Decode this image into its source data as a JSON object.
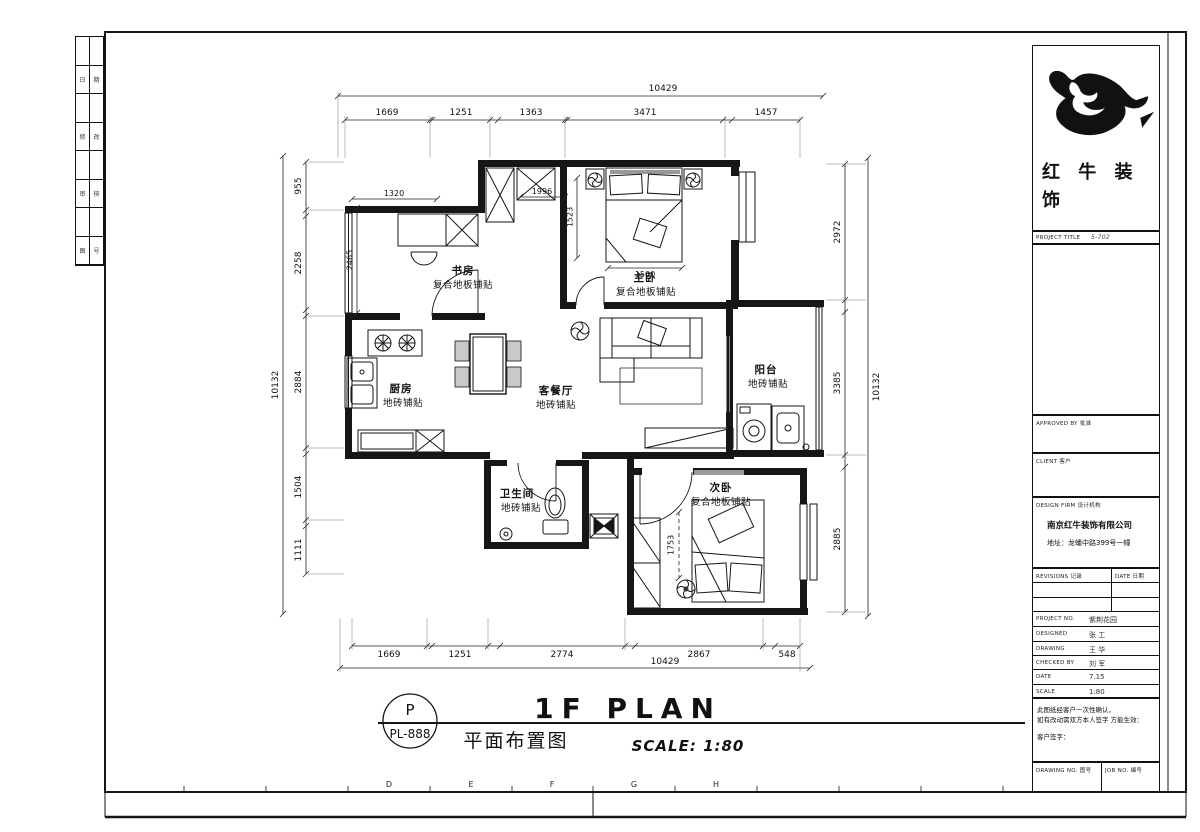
{
  "sheet": {
    "grid_letters": [
      "D",
      "E",
      "F",
      "G",
      "H"
    ],
    "stamp": {
      "symbol": "P",
      "code": "PL-888"
    },
    "title": {
      "en": "1F PLAN",
      "cn": "平面布置图",
      "scale": "SCALE: 1:80"
    }
  },
  "edge_strip": {
    "cells": [
      "日",
      "期",
      "修",
      "改",
      "审",
      "核",
      "图",
      "号"
    ]
  },
  "rooms": {
    "study": {
      "name": "书房",
      "floor": "复合地板铺贴"
    },
    "master": {
      "name": "主卧",
      "floor": "复合地板铺贴"
    },
    "kitchen": {
      "name": "厨房",
      "floor": "地砖铺贴"
    },
    "living": {
      "name": "客餐厅",
      "floor": "地砖铺贴"
    },
    "balcony": {
      "name": "阳台",
      "floor": "地砖铺贴"
    },
    "bath": {
      "name": "卫生间",
      "floor": "地砖铺贴"
    },
    "second": {
      "name": "次卧",
      "floor": "复合地板铺贴"
    }
  },
  "dims": {
    "top_overall": "10429",
    "top": [
      "1669",
      "1251",
      "1363",
      "3471",
      "1457"
    ],
    "bottom": [
      "1669",
      "1251",
      "2774",
      "2867",
      "548"
    ],
    "bottom_overall": "10429",
    "left": [
      "955",
      "2258",
      "2884",
      "1504",
      "1111"
    ],
    "left_overall": "10132",
    "right": [
      "2972",
      "3385",
      "2885"
    ],
    "right_overall": "10132",
    "inner": {
      "study_w": "1320",
      "study_h": "2465",
      "entry": "1996",
      "master_h": "1523",
      "bed_w": "1500",
      "second_h": "1753"
    }
  },
  "panel": {
    "logo_cn_line1": "红 牛 装",
    "logo_cn_line2": "饰",
    "project_title_label": "PROJECT TITLE",
    "project_title_value": "5-702",
    "approved_label": "APPROVED BY  批准",
    "client_label": "CLIENT  客户",
    "firm_label": "DESIGN FIRM  设计机构",
    "company_name": "南京红牛装饰有限公司",
    "company_address": "地址：龙蟠中路399号一幢",
    "revisions_label": "REVISIONS  记录",
    "date_col_label": "DATE  日期",
    "rows": [
      {
        "label": "PROJECT NO.",
        "value": "紫荆花园"
      },
      {
        "label": "DESIGNED",
        "value": "张 工"
      },
      {
        "label": "DRAWING",
        "value": "王 华"
      },
      {
        "label": "CHECKED BY",
        "value": "刘 军"
      },
      {
        "label": "DATE",
        "value": "7.15"
      },
      {
        "label": "SCALE",
        "value": "1:80"
      }
    ],
    "note_line1": "此图纸经客户一次性确认，",
    "note_line2": "如有改动需双方本人签字 方能生效：",
    "note_line3": "客户签字：",
    "drawing_no_label": "DRAWING NO.  图号",
    "job_no_label": "JOB NO.  编号"
  }
}
